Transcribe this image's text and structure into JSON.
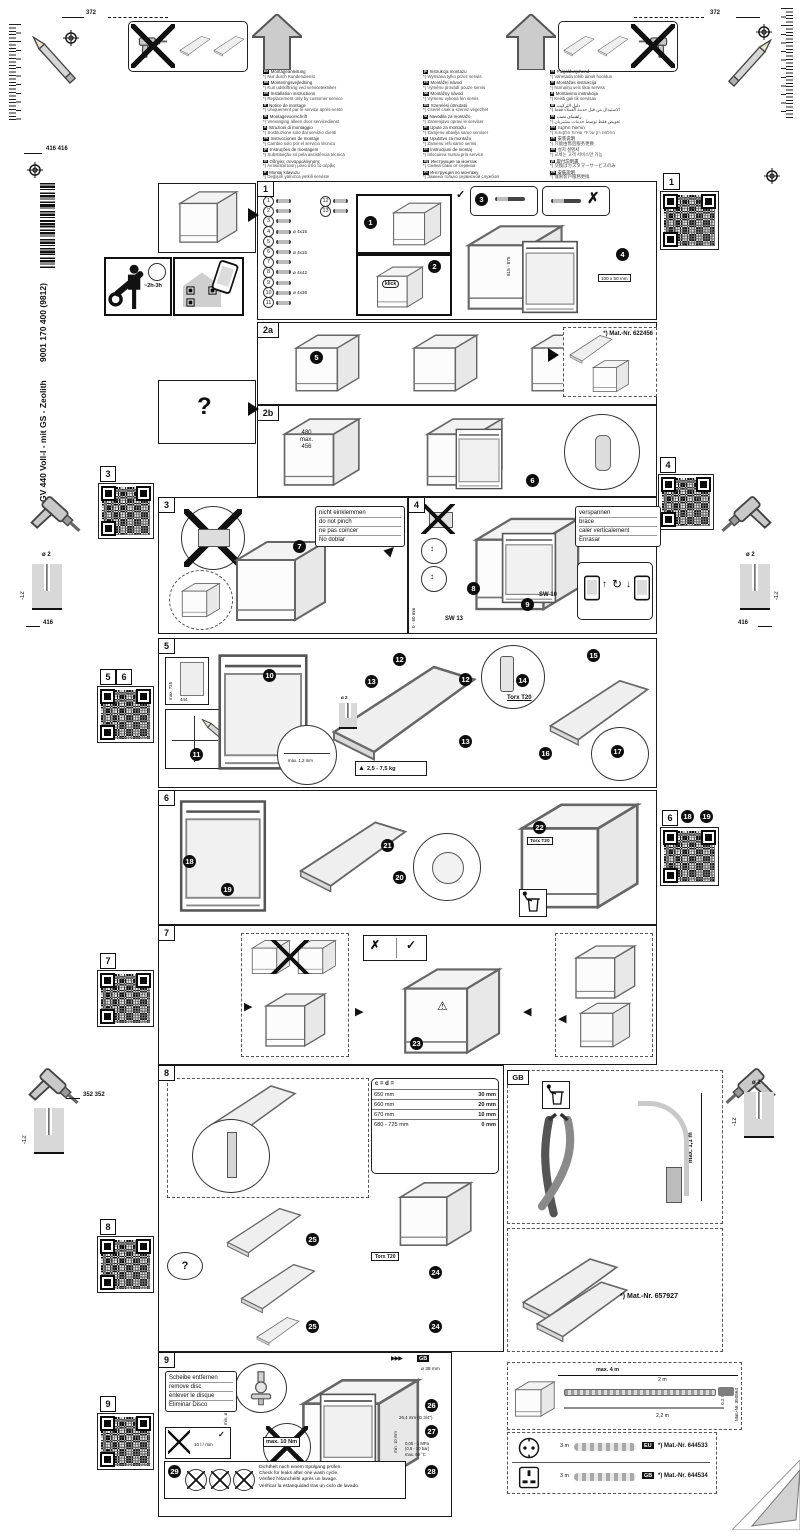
{
  "product": {
    "model": "GV 440 Voll-I - mit GS - Zeolith",
    "number": "9001 170 400 (9812)"
  },
  "margins": {
    "dim_372_left": "372",
    "dim_372_right": "372",
    "dim_416_pair": "416 416",
    "dim_416_left": "416",
    "dim_416_right": "416",
    "dim_352": "352 352",
    "drill_dia": "ø 2",
    "drill_depth": "-12",
    "time_estimate": "~2h-3h"
  },
  "languages": {
    "col1": [
      {
        "c": "de",
        "t": "Montageanleitung",
        "s": "*) Nur durch Kundendienst"
      },
      {
        "c": "da",
        "t": "Monteringsvejledning",
        "s": "*) Kun udskiftning ved servicetekniker"
      },
      {
        "c": "en",
        "t": "Installation instructions",
        "s": "*) Replacement only by customer service"
      },
      {
        "c": "fr",
        "t": "Notice de montage",
        "s": "*) Uniquement par le service après-vente"
      },
      {
        "c": "nl",
        "t": "Montagevoorschrift",
        "s": "*) Vervanging alleen door servicedienst"
      },
      {
        "c": "it",
        "t": "Istruzioni di montaggio",
        "s": "*) Sostituzione solo dal servizio clienti"
      },
      {
        "c": "es",
        "t": "Instrucciones de montaje",
        "s": "*) Cambio solo por el servicio técnico"
      },
      {
        "c": "pt",
        "t": "Instruções de montagem",
        "s": "*) Substituição só pela assistência técnica"
      },
      {
        "c": "el",
        "t": "Οδηγίες συναρμολόγησης",
        "s": "*) Αντικατάσταση μόνο από το σέρβις"
      },
      {
        "c": "tr",
        "t": "Montaj kılavuzu",
        "s": "*) Değişim yalnızca yetkili serviste"
      },
      {
        "c": "sv",
        "t": "Monteringsanvisning",
        "s": "*) Byte endast av servicetekniker"
      }
    ],
    "col2": [
      {
        "c": "pl",
        "t": "Instrukcja montażu",
        "s": "*) Wymiana tylko przez serwis"
      },
      {
        "c": "cs",
        "t": "Montážní návod",
        "s": "*) Výměnu provádí pouze servis"
      },
      {
        "c": "sk",
        "t": "Montážny návod",
        "s": "*) Výmenu vykoná len servis"
      },
      {
        "c": "hu",
        "t": "Szerelési útmutató",
        "s": "*) Cserét csak a szerviz végezhet"
      },
      {
        "c": "sl",
        "t": "Navodila za montažo",
        "s": "*) Zamenjavo opravi le serviser"
      },
      {
        "c": "hr",
        "t": "Upute za montažu",
        "s": "*) Zamjenu obavlja samo serviser"
      },
      {
        "c": "sr",
        "t": "Uputstvo za montažu",
        "s": "*) Zamenu vrši samo servis"
      },
      {
        "c": "ro",
        "t": "Instrucţiuni de montaj",
        "s": "*) Înlocuirea numai prin service"
      },
      {
        "c": "bg",
        "t": "Инструкция за монтаж",
        "s": "*) Смяна само от сервиза"
      },
      {
        "c": "ru",
        "t": "Инструкция по монтажу",
        "s": "*) Замена только сервисной службой"
      },
      {
        "c": "uk",
        "t": "Інструкція з монтажу",
        "s": "*) Заміна лише сервісною службою"
      }
    ],
    "col3": [
      {
        "c": "et",
        "t": "Paigaldusjuhend",
        "s": "*) Vahetada tohib ainult hooldus"
      },
      {
        "c": "lv",
        "t": "Montāžas instrukcija",
        "s": "*) Nomaiņu veic tikai serviss"
      },
      {
        "c": "lt",
        "t": "Montavimo instrukcija",
        "s": "*) Keisti gali tik servisas"
      },
      {
        "c": "ar",
        "t": "دليل التركيب",
        "s": "*) الاستبدال من قبل خدمة العملاء فقط"
      },
      {
        "c": "fa",
        "t": "راهنمای نصب",
        "s": "*) تعویض فقط توسط خدمات مشتریان"
      },
      {
        "c": "he",
        "t": "הוראות התקנה",
        "s": "*) החלפה רק על ידי שירות הלקוחות"
      },
      {
        "c": "zh",
        "t": "安装说明",
        "s": "*) 只能由售后服务更换"
      },
      {
        "c": "ko",
        "t": "설치 설명서",
        "s": "*) 교체는 고객 서비스만 가능"
      },
      {
        "c": "ja",
        "t": "取付説明書",
        "s": "*) 交換はカスタマーサービスのみ"
      },
      {
        "c": "tw",
        "t": "安裝說明",
        "s": "*) 僅限客戶服務更換"
      }
    ]
  },
  "steps": {
    "s1": {
      "label": "1",
      "klick": "klick",
      "dim_height": "815 - 875",
      "tag": "100 x 50 mm",
      "check": "✓",
      "cross": "✗",
      "callouts": [
        "1",
        "2",
        "3",
        "4"
      ],
      "parts": [
        {
          "n": "1",
          "s": ""
        },
        {
          "n": "2",
          "s": ""
        },
        {
          "n": "3",
          "s": ""
        },
        {
          "n": "4",
          "s": "ø 4x15"
        },
        {
          "n": "5",
          "s": ""
        },
        {
          "n": "6",
          "s": "ø 4x15"
        },
        {
          "n": "7",
          "s": ""
        },
        {
          "n": "8",
          "s": "ø 4x42"
        },
        {
          "n": "9",
          "s": ""
        },
        {
          "n": "10",
          "s": "ø 4x36"
        },
        {
          "n": "11",
          "s": ""
        }
      ],
      "parts_extra": [
        {
          "n": "12",
          "s": ""
        },
        {
          "n": "13",
          "s": ""
        }
      ]
    },
    "s2a": {
      "label": "2a",
      "matnr": "*) Mat.-Nr. 622456",
      "callout": "5"
    },
    "s2b": {
      "label": "2b",
      "dims": [
        "480",
        "max.",
        "456"
      ],
      "callout": "6"
    },
    "s3": {
      "label": "3",
      "callout": "7",
      "note": [
        "nicht einklemmen",
        "do not pinch",
        "ne pas coincer",
        "No doblar"
      ]
    },
    "s4": {
      "label": "4",
      "note": [
        "verspannen",
        "brace",
        "caler verticalement",
        "Enrasar"
      ],
      "callouts": [
        "8",
        "9"
      ],
      "sw13": "SW 13",
      "sw10": "SW 10",
      "dim": "0 - 60 mm"
    },
    "s5": {
      "label": "5",
      "callouts": [
        "10",
        "11",
        "12",
        "13",
        "14",
        "15",
        "16",
        "17"
      ],
      "dim_h": "max. 725",
      "dim_w": "444",
      "gap": "max. 1,2 mm",
      "torx": "Torx T20",
      "weight": "2,5 - 7,5 kg",
      "drill": "ø 2"
    },
    "s6": {
      "label": "6",
      "callouts": [
        "18",
        "19",
        "20",
        "21",
        "22"
      ],
      "torx": "Torx T20"
    },
    "s7": {
      "label": "7",
      "callout": "23",
      "check": "✓",
      "cross": "✗",
      "warning": "⚠"
    },
    "s8": {
      "label": "8",
      "callouts": [
        "24",
        "25"
      ],
      "torx": "Torx T20",
      "question": "?",
      "table": {
        "header": "c = d =",
        "rows": [
          {
            "c": "650 mm",
            "d": "30 mm"
          },
          {
            "c": "660 mm",
            "d": "20 mm"
          },
          {
            "c": "670 mm",
            "d": "10 mm"
          },
          {
            "c": "680 - 725 mm",
            "d": "0 mm"
          }
        ]
      },
      "gb": {
        "label": "GB",
        "max_height": "max. 1,1 m"
      },
      "matnr": "*) Mat.-Nr. 657927"
    },
    "s9": {
      "label": "9",
      "badge": "GB",
      "icons": "▶▶▶",
      "callouts": [
        "26",
        "27",
        "28",
        "29"
      ],
      "remove_disc": [
        "Scheibe entfernen",
        "remove disc",
        "enlever le disque",
        "Eliminar Disco"
      ],
      "torque": "max. 10 Nm",
      "flow": "10 l / min",
      "min_dia": "min. ø 18 mm",
      "hole": "ø 38 mm",
      "thread": "26,4 mm (G 3/4\")",
      "min10": "min. 10 mm",
      "pressure": [
        "0,05 - 1 MPa",
        "(0,5 - 10 bar)",
        "max. 60 °C"
      ],
      "leak_check": [
        "Dichtheit nach einem Spülgang prüfen.",
        "Check for leaks after one wash cycle.",
        "Vérifiez l'étanchéité après un lavage.",
        "Verificar la estanquidad tras un ciclo de lavado."
      ]
    }
  },
  "accessories": {
    "hose": {
      "max": "max. 4 m",
      "l2": "2 m",
      "l02": "0,2 m",
      "l22": "2,2 m",
      "matnr": "Mat.-Nr. 350564"
    },
    "cords": [
      {
        "badge": "EU",
        "length": "3 m",
        "matnr": "*) Mat.-Nr. 644533"
      },
      {
        "badge": "GB",
        "length": "3 m",
        "matnr": "*) Mat.-Nr. 644534"
      }
    ]
  }
}
